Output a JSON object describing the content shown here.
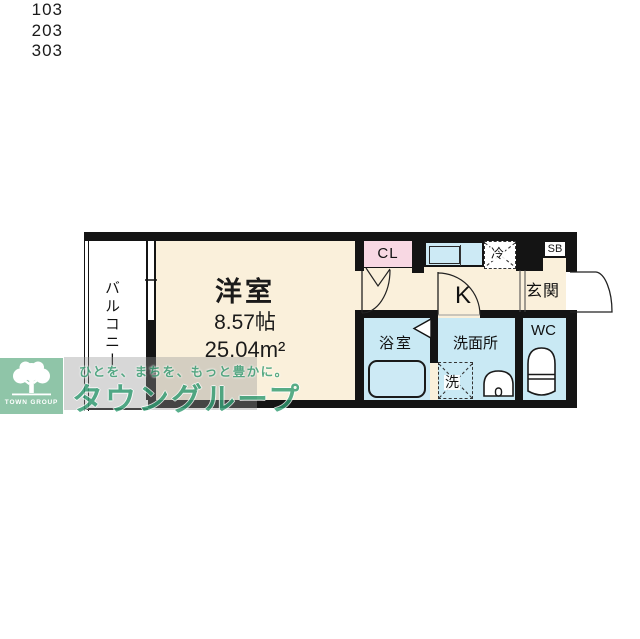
{
  "unit_numbers": [
    "103",
    "203",
    "303"
  ],
  "plan": {
    "balcony_label": "バルコニー",
    "main_room": {
      "name": "洋室",
      "size_tatami": "8.57帖",
      "area": "25.04m²"
    },
    "closet_label": "CL",
    "kitchen_label": "K",
    "fridge_label": "冷",
    "shoebox_label": "SB",
    "entrance_label": "玄関",
    "bath_label": "浴室",
    "washroom_label": "洗面所",
    "washer_label": "洗",
    "wc_label": "WC"
  },
  "watermark": {
    "tagline": "ひとを、まちを、もっと豊かに。",
    "brand": "タウングループ"
  },
  "logo": {
    "name": "TOWN GROUP"
  },
  "colors": {
    "room_fill": "#FAF0DB",
    "wet_area_fill": "#C9E9F4",
    "closet_fill": "#F8D8E3",
    "wall": "#141414",
    "brand_green": "#2F9C71",
    "logo_green": "#8FC5A8"
  }
}
